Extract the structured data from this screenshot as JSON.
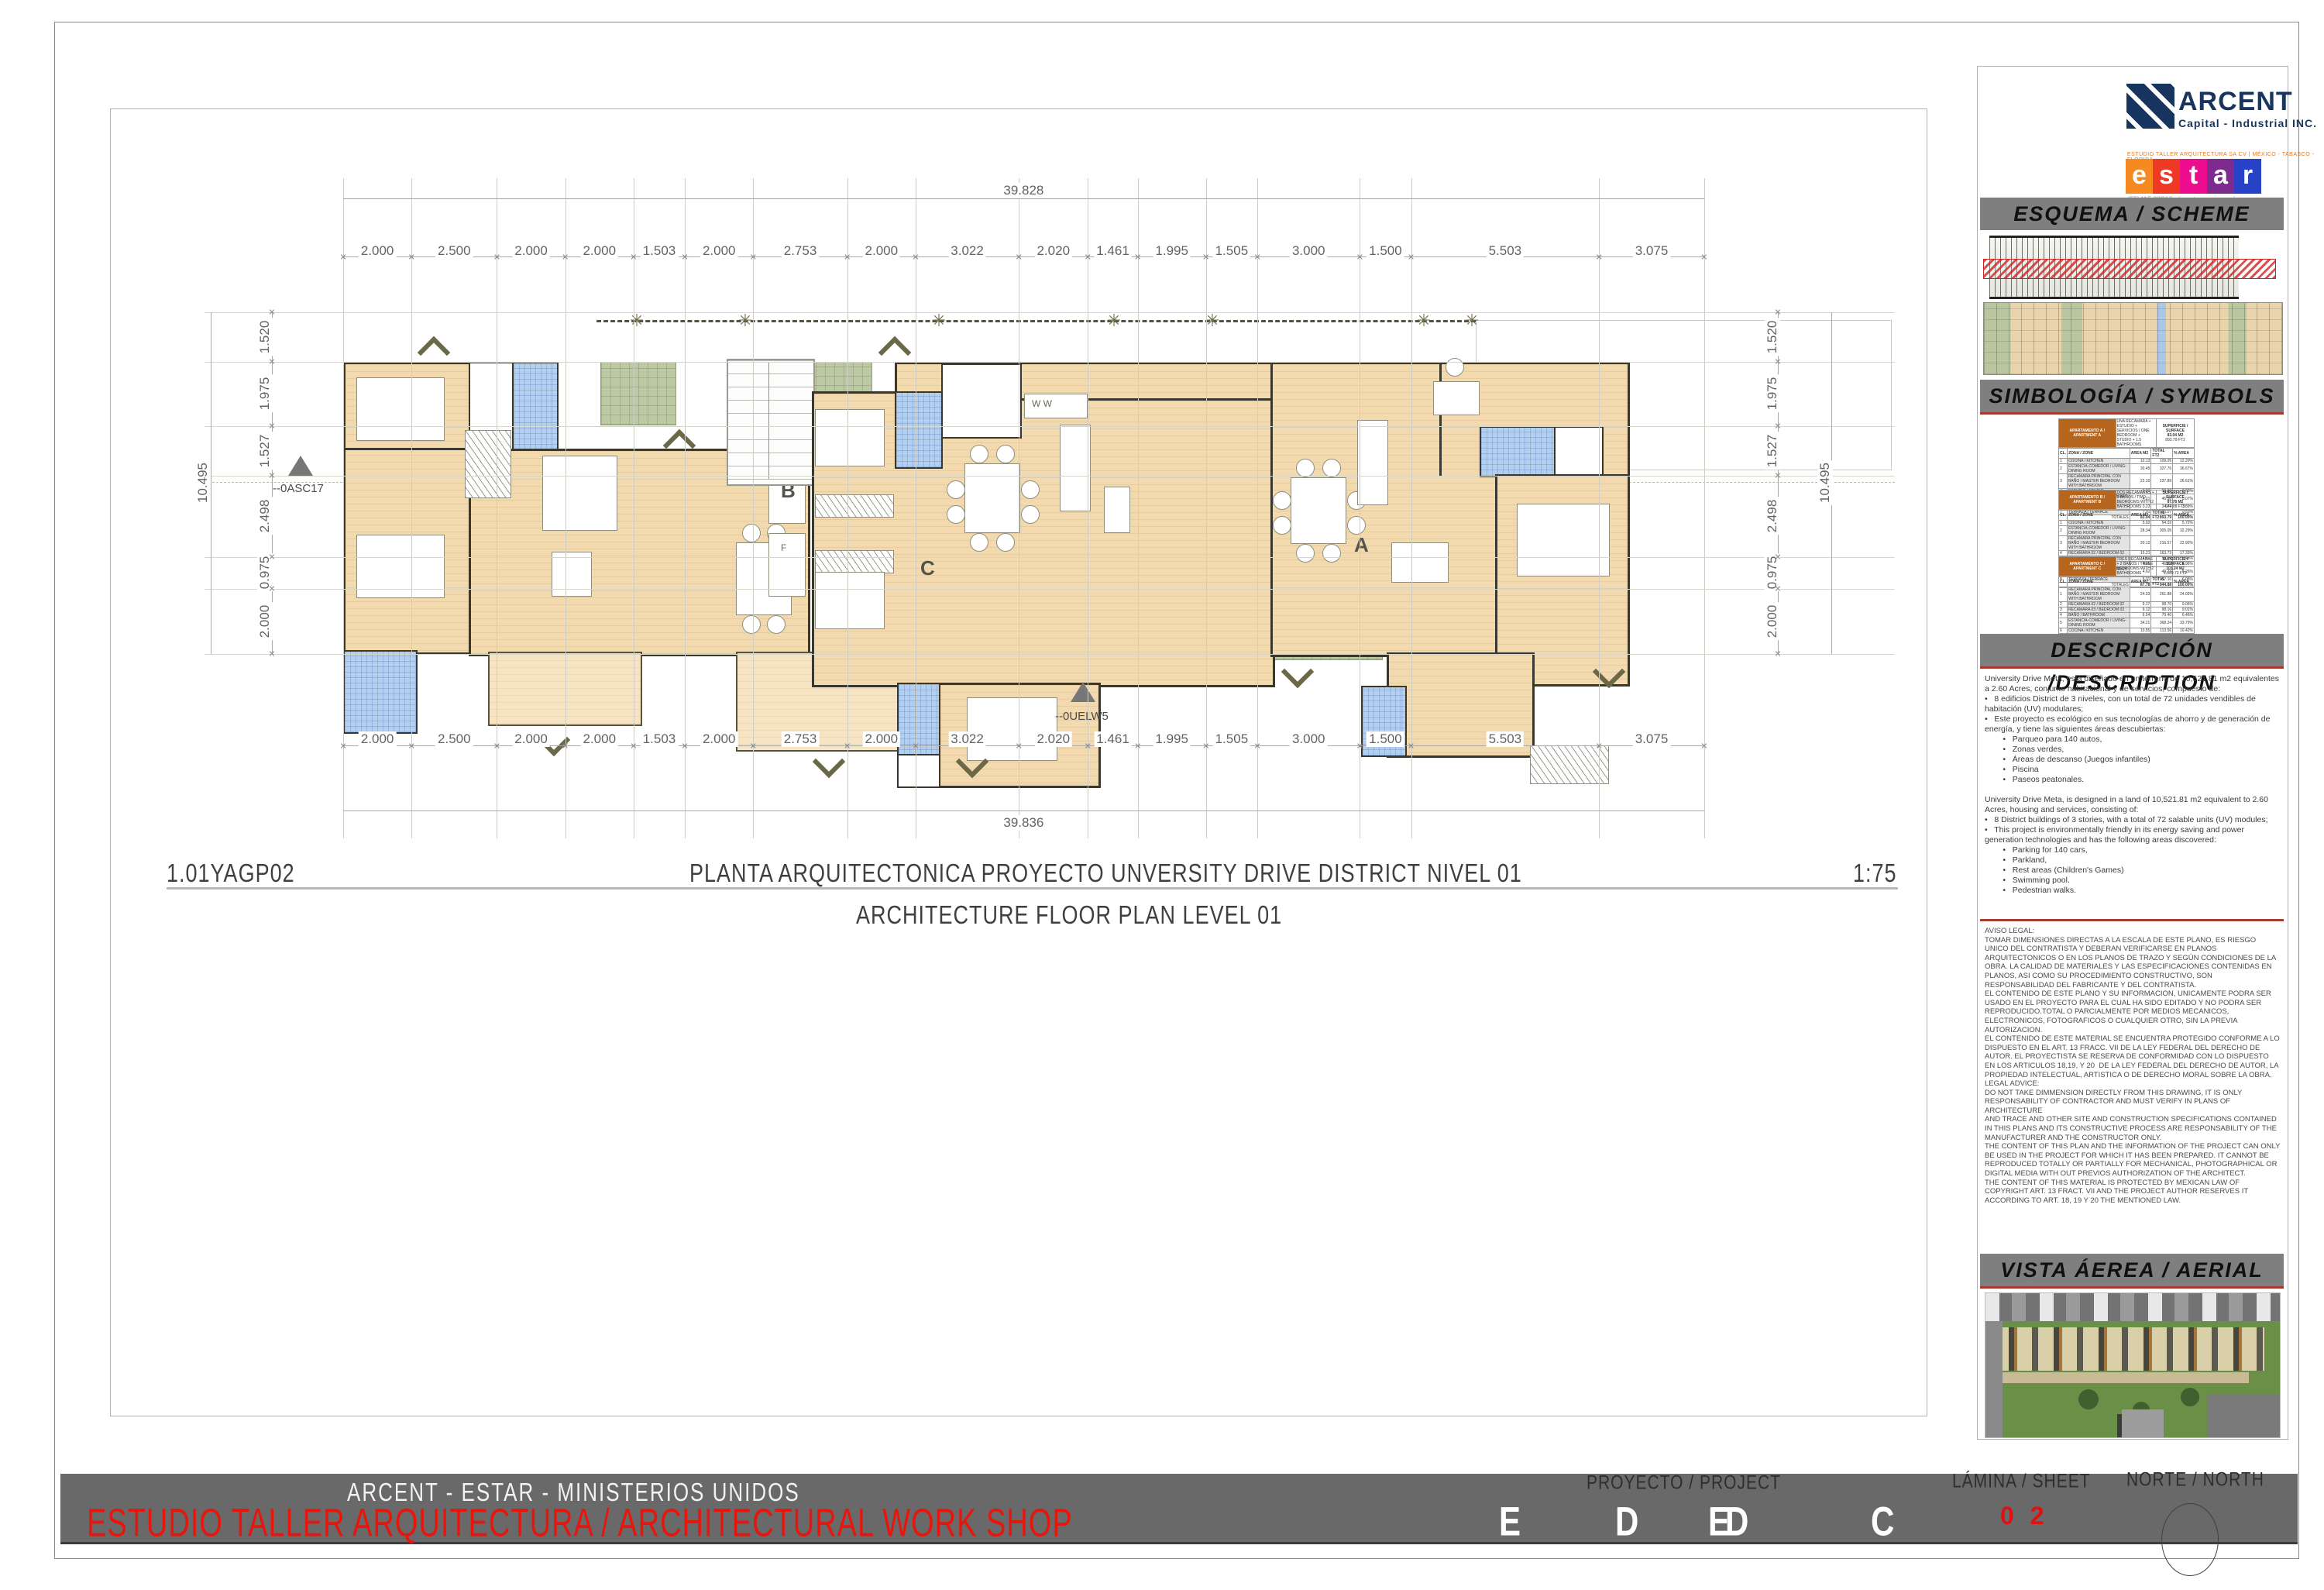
{
  "plan": {
    "h_total_top": "39.828",
    "h_total_bottom": "39.836",
    "h_dims": [
      "2.000",
      "2.500",
      "2.000",
      "2.000",
      "1.503",
      "2.000",
      "2.753",
      "2.000",
      "3.022",
      "2.020",
      "1.461",
      "1.995",
      "1.505",
      "3.000",
      "1.500",
      "5.503",
      "3.075"
    ],
    "v_dims": [
      "1.520",
      "1.975",
      "1.527",
      "2.498",
      "0.975",
      "2.000"
    ],
    "v_total": "10.495",
    "units": {
      "b": "B",
      "c": "C",
      "a": "A"
    },
    "markers": {
      "left": "--0ASC17",
      "center": "--0UELW5"
    },
    "appliances": {
      "w": "W",
      "f": "F",
      "ww": "W W"
    },
    "title": {
      "code": "1.01YAGP02",
      "es": "PLANTA ARQUITECTONICA PROYECTO UNVERSITY DRIVE DISTRICT NIVEL 01",
      "scale": "1:75",
      "en": "ARCHITECTURE FLOOR PLAN LEVEL 01"
    }
  },
  "panel": {
    "arcent": {
      "name": "ARCENT",
      "tagline": "Capital - Industrial INC."
    },
    "estar": {
      "tagline": "ESTUDIO TALLER ARQUITECTURA SA CV | MÉXICO - TABASCO - FLORIDA",
      "letters": [
        "e",
        "s",
        "t",
        "a",
        "r"
      ],
      "tile_colors": [
        "#F6891F",
        "#EE3A24",
        "#EC0C8D",
        "#7E2B90",
        "#2742C6"
      ],
      "contact": "(55)415 98310   |   estar.com.mx   |\ninfo@estar.com.mx"
    },
    "headers": {
      "esquema": "ESQUEMA / SCHEME",
      "simbologia": "SIMBOLOGÍA / SYMBOLS",
      "descripcion": "DESCRIPCIÓN /DESCRIPTION",
      "vista": "VISTA ÁEREA / AERIAL VIEW"
    },
    "table_columns": [
      "CL.",
      "ZONA / ZONE",
      "AREA M2",
      "TOTAL FT2",
      "% AREA"
    ],
    "totals_label": "TOTALES",
    "superficie_label": "SUPERFICIE / SURFACE",
    "tables": [
      {
        "name": "APARTAMENTO A / APARTMENT A",
        "note": "UNA RECAMARA + ESTUDIO + SERVICIOS / ONE BEDROOM + STUDIO + 1.5 BATHROOMS",
        "m2": "83.04 M2",
        "ft2": "893.79 FT2",
        "rows": [
          [
            "1",
            "COCINA / KITCHEN",
            "10.13",
            "109.05",
            "12.20%"
          ],
          [
            "2",
            "ESTANCIA-COMEDOR / LIVING-DINING ROOM",
            "30.45",
            "327.76",
            "36.67%"
          ],
          [
            "3",
            "RECAMARA PRINCIPAL CON BAÑO / MASTER BEDROOM WITH BATHROOM",
            "22.10",
            "237.89",
            "26.61%"
          ],
          [
            "4",
            "ESTUDIO / STUDIO",
            "5.01",
            "53.93",
            "6.03%"
          ],
          [
            "5",
            "PATIO DE SERVICIO / LAUNDRY ROOM",
            "4.21",
            "45.32",
            "5.07%"
          ],
          [
            "6",
            "BAÑO / BATHROOM",
            "3.23",
            "34.77",
            "3.89%"
          ],
          [
            "7",
            "TERRAZA / TERRACE",
            "7.91",
            "85.07",
            "9.53%"
          ]
        ],
        "totals": [
          "83.04",
          "893.79",
          "100.00%"
        ]
      },
      {
        "name": "APARTAMENTO B / APARTMENT B",
        "note": "DOS RECAMARAS + 2 BAÑOS / TWO BEDROOMS WITH 2 BATHROOMS",
        "m2": "87.78 M2",
        "ft2": "944.88 FT2",
        "rows": [
          [
            "1",
            "COCINA / KITCHEN",
            "5.02",
            "54.03",
            "5.72%"
          ],
          [
            "2",
            "ESTANCIA-COMEDOR / LIVING-DINING ROOM",
            "28.34",
            "305.05",
            "32.29%"
          ],
          [
            "3",
            "RECAMARA PRINCIPAL CON BAÑO / MASTER BEDROOM WITH BATHROOM",
            "20.12",
            "216.57",
            "22.92%"
          ],
          [
            "4",
            "RECAMARA 02 / BEDROOM 02",
            "15.21",
            "163.73",
            "17.33%"
          ],
          [
            "5",
            "ESTUDIO / STUDIO",
            "4.81",
            "51.77",
            "5.48%"
          ],
          [
            "6",
            "BAÑO / BATHROOM",
            "4.35",
            "46.82",
            "4.96%"
          ],
          [
            "7",
            "PATIO DE SERVICIO / LAUNDRY ROOM",
            "4.62",
            "49.73",
            "5.26%"
          ],
          [
            "8",
            "TERRAZA / TERRACE",
            "5.31",
            "57.16",
            "6.05%"
          ]
        ],
        "totals": [
          "87.78",
          "944.88",
          "100.00%"
        ]
      },
      {
        "name": "APARTAMENTO C / APARTMENT C",
        "note": "TRES RECAMARAS + 2 BAÑOS / THREE BEDROOMS WITH 2 BATHROOMS",
        "m2": "101.24 M2",
        "ft2": "1,089.73 FT2",
        "rows": [
          [
            "1",
            "RECAMARA PRINCIPAL CON BAÑO / MASTER BEDROOM WITH BATHROOM",
            "24.33",
            "261.88",
            "24.03%"
          ],
          [
            "2",
            "RECAMARA 02 / BEDROOM 02",
            "9.17",
            "98.70",
            "9.06%"
          ],
          [
            "3",
            "RECAMARA 03 / BEDROOM 03",
            "9.12",
            "98.16",
            "9.01%"
          ],
          [
            "4",
            "BAÑO / BATHROOM",
            "6.54",
            "70.40",
            "6.46%"
          ],
          [
            "5",
            "ESTANCIA-COMEDOR / LIVING-DINING ROOM",
            "34.21",
            "368.24",
            "33.79%"
          ],
          [
            "6",
            "COCINA / KITCHEN",
            "10.55",
            "113.56",
            "10.42%"
          ],
          [
            "7",
            "PATIO DE SERVICIO / LAUNDRY ROOM",
            "4.21",
            "45.32",
            "4.16%"
          ],
          [
            "8",
            "TERRAZA / TERRACE",
            "3.11",
            "33.47",
            "3.07%"
          ]
        ],
        "totals": [
          "101.24",
          "1,089.73",
          "100.00%"
        ]
      }
    ],
    "description_es": "University Drive Meta, está diseñado en un terreno de 10,521.81 m2 equivalentes a 2.60 Acres, conjunto habitacional y de servicios, compuesto de:\n•   8 edificios District de 3 niveles, con un total de 72 unidades vendibles de habitación (UV) modulares;\n•   Este proyecto es ecológico en sus tecnologías de ahorro y de generación de energía, y tiene las siguientes áreas descubiertas:\n        •   Parqueo para 140 autos,\n        •   Zonas verdes,\n        •   Áreas de descanso (Juegos infantiles)\n        •   Piscina\n        •   Paseos peatonales.",
    "description_en": "University Drive Meta, is designed in a land of 10,521.81 m2 equivalent to 2.60 Acres, housing and services, consisting of:\n•   8 District buildings of 3 stories, with a total of 72 salable units (UV) modules;\n•   This project is environmentally friendly in its energy saving and power generation technologies and has the following areas discovered:\n        •   Parking for 140 cars,\n        •   Parkland,\n        •   Rest areas (Children's Games)\n        •   Swimming pool.\n        •   Pedestrian walks.",
    "legal": "AVISO LEGAL:\nTOMAR DIMENSIONES DIRECTAS A LA ESCALA DE ESTE PLANO, ES RIESGO UNICO DEL CONTRATISTA Y DEBERAN VERIFICARSE EN PLANOS ARQUITECTONICOS O EN LOS PLANOS DE TRAZO Y SEGÚN CONDICIONES DE LA OBRA. LA CALIDAD DE MATERIALES Y LAS ESPECIFICACIONES CONTENIDAS EN PLANOS, ASI COMO SU PROCEDIMIENTO CONSTRUCTIVO, SON RESPONSABILIDAD DEL FABRICANTE Y DEL CONTRATISTA.\nEL CONTENIDO DE ESTE PLANO Y SU INFORMACION, UNICAMENTE PODRA SER USADO EN EL PROYECTO PARA EL CUAL HA SIDO EDITADO Y NO PODRA SER REPRODUCIDO.TOTAL O PARCIALMENTE POR MEDIOS MECANICOS, ELECTRONICOS, FOTOGRAFICOS O CUALQUIER OTRO, SIN LA PREVIA AUTORIZACION.\nEL CONTENIDO DE ESTE MATERIAL SE ENCUENTRA PROTEGIDO CONFORME A LO DISPUESTO EN EL ART. 13 FRACC. VII DE LA LEY FEDERAL DEL DERECHO DE AUTOR. EL PROYECTISTA SE RESERVA DE CONFORMIDAD CON LO DISPUESTO EN LOS ARTICULOS 18,19, Y 20  DE LA LEY FEDERAL DEL DERECHO DE AUTOR, LA PROPIEDAD INTELECTUAL, ARTISTICA O DE DERECHO MORAL SOBRE LA OBRA.\nLEGAL ADVICE:\nDO NOT TAKE DIMMENSION DIRECTLY FROM THIS DRAWING, IT IS ONLY RESPONSABILITY OF CONTRACTOR AND MUST VERIFY IN PLANS OF ARCHITECTURE\nAND TRACE AND OTHER SITE AND CONSTRUCTION SPECIFICATIONS CONTAINED IN THIS PLANS AND ITS CONSTRUCTIVE PROCESS ARE RESPONSABILITY OF THE MANUFACTURER AND THE CONSTRUCTOR ONLY.\nTHE CONTENT OF THIS PLAN AND THE INFORMATION OF THE PROJECT CAN ONLY BE USED IN THE PROJECT FOR WHICH IT HAS BEEN PREPARED. IT CANNOT BE REPRODUCED TOTALLY OR PARTIALLY FOR MECHANICAL, PHOTOGRAPHICAL OR DIGITAL MEDIA WITH OUT PREVIOS AUTHORIZATION OF THE ARCHITECT.\nTHE CONTENT OF THIS MATERIAL IS PROTECTED BY MEXICAN LAW OF COPYRIGHT ART. 13 FRACT. VII AND THE PROJECT AUTHOR RESERVES IT ACCORDING TO ART. 18, 19 Y 20 THE MENTIONED LAW."
  },
  "footer": {
    "line1": "ARCENT - ESTAR - MINISTERIOS UNIDOS",
    "line2": "ESTUDIO TALLER ARQUITECTURA  / ARCHITECTURAL WORK SHOP",
    "project_label": "PROYECTO / PROJECT",
    "codes": [
      "E",
      "D",
      "ED",
      "C"
    ],
    "sheet_label": "LÁMINA / SHEET",
    "sheet_number": "0 2",
    "north_label": "NORTE / NORTH"
  }
}
